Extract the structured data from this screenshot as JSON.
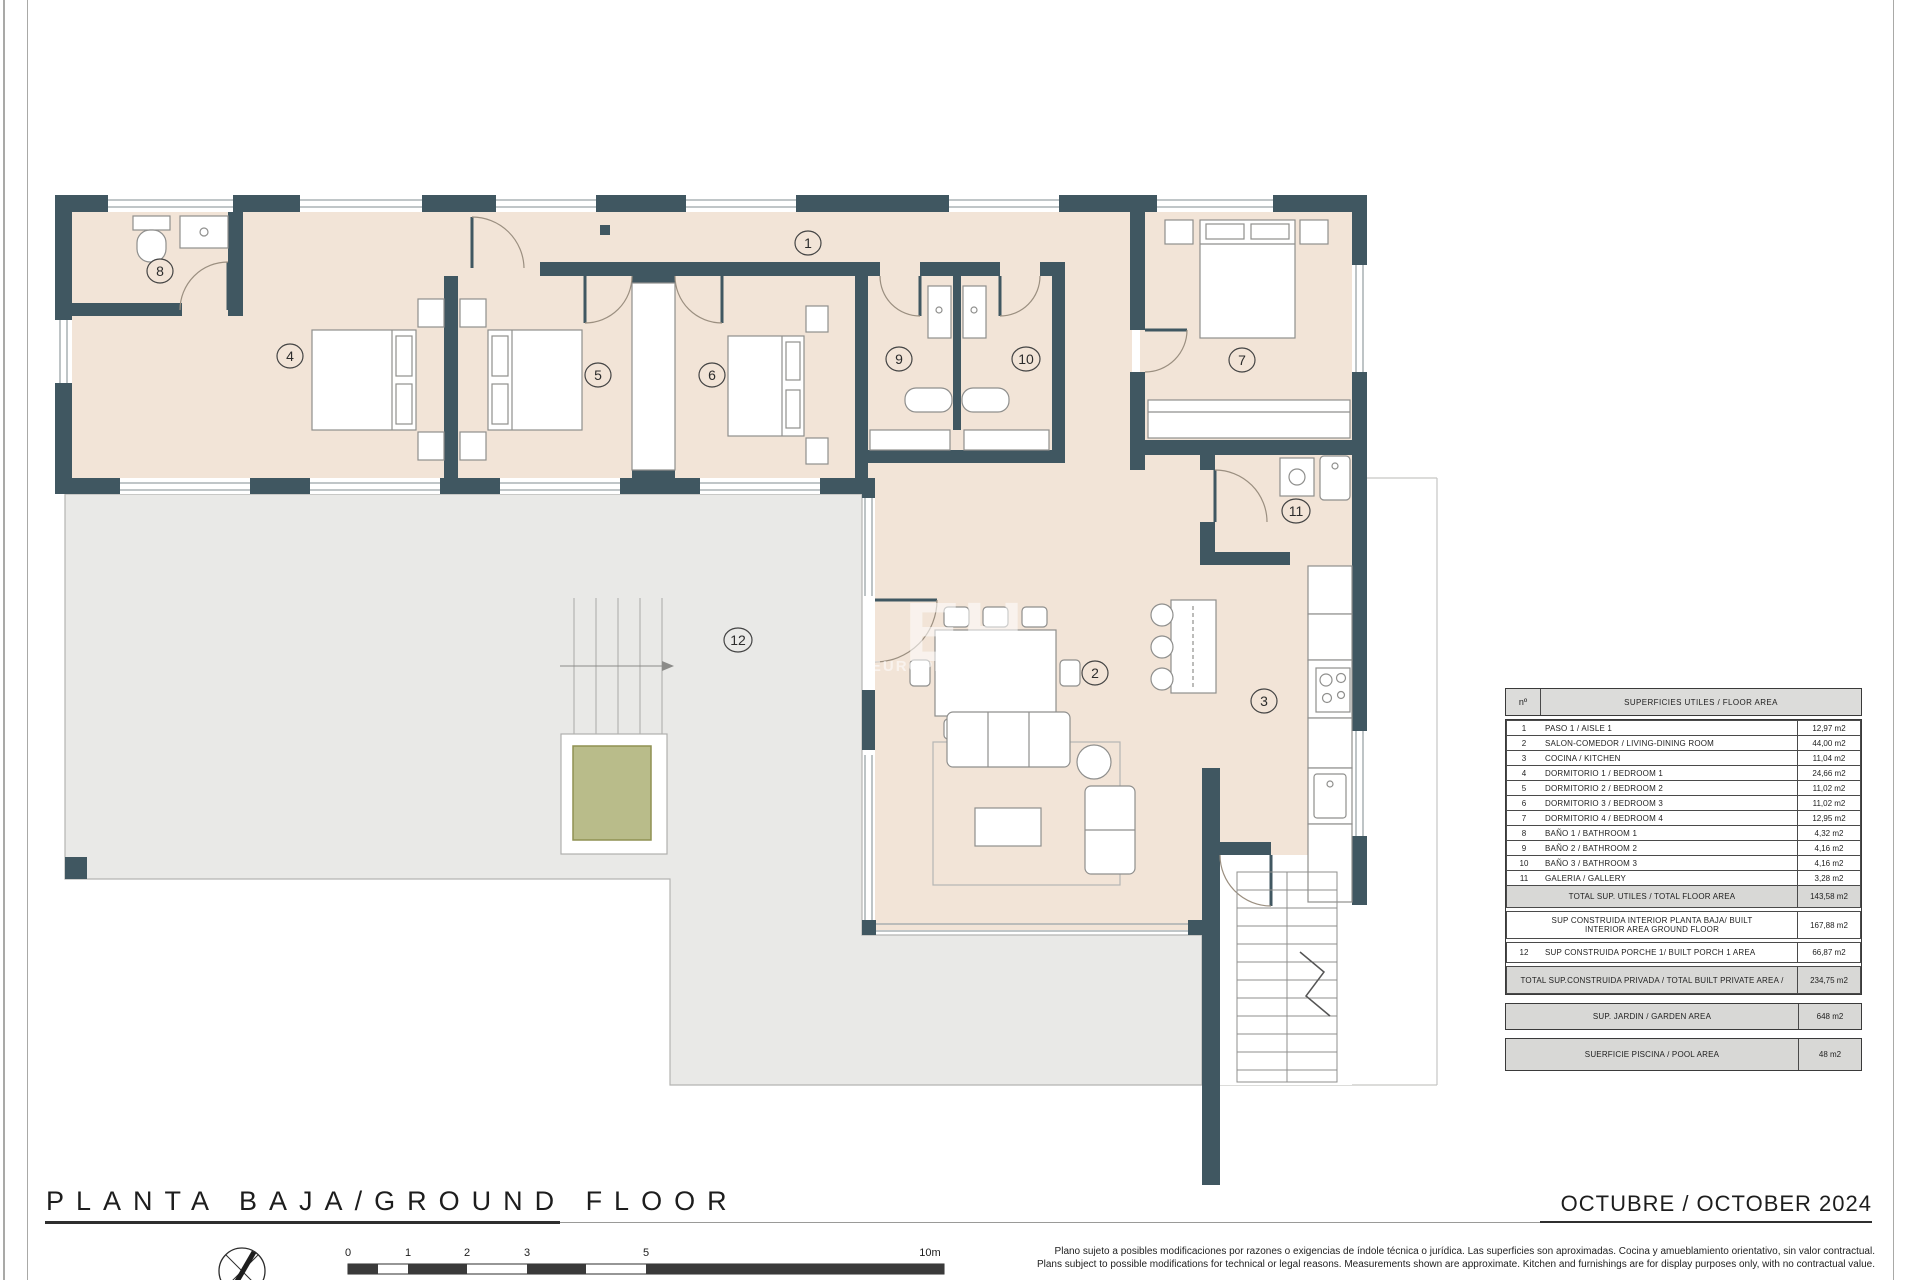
{
  "page": {
    "title": "PLANTA BAJA/GROUND FLOOR",
    "date": "OCTUBRE / OCTOBER 2024",
    "disclaimer_es": "Plano sujeto a posibles modificaciones por razones o exigencias de índole técnica o jurídica. Las superficies son aproximadas. Cocina y amueblamiento orientativo, sin valor contractual.",
    "disclaimer_en": "Plans subject to possible modifications for technical or legal reasons. Measurements shown are approximate. Kitchen and furnishings are for display purposes only, with no contractual value."
  },
  "watermark": {
    "initials": "EH",
    "name_primary": "EUROPE",
    "name_secondary": "h o m e s"
  },
  "colors": {
    "wall": "#405761",
    "floor": "#f2e4d7",
    "terrace": "#e9e9e7",
    "pool_green": "#b9bc8a",
    "table_gray": "#d8d8d6"
  },
  "scalebar": {
    "labels": [
      "0",
      "1",
      "2",
      "3",
      "5",
      "10m"
    ]
  },
  "plan": {
    "rooms": [
      {
        "num": "1",
        "label": "PASO 1 / AISLE 1"
      },
      {
        "num": "2",
        "label": "SALON-COMEDOR / LIVING-DINING ROOM"
      },
      {
        "num": "3",
        "label": "COCINA / KITCHEN"
      },
      {
        "num": "4",
        "label": "DORMITORIO 1 / BEDROOM 1"
      },
      {
        "num": "5",
        "label": "DORMITORIO 2 / BEDROOM 2"
      },
      {
        "num": "6",
        "label": "DORMITORIO 3 / BEDROOM 3"
      },
      {
        "num": "7",
        "label": "DORMITORIO 4 / BEDROOM 4"
      },
      {
        "num": "8",
        "label": "BAÑO 1 / BATHROOM 1"
      },
      {
        "num": "9",
        "label": "BAÑO 2 / BATHROOM 2"
      },
      {
        "num": "10",
        "label": "BAÑO 3 / BATHROOM 3"
      },
      {
        "num": "11",
        "label": "GALERIA / GALLERY"
      },
      {
        "num": "12",
        "label": "SUP CONSTRUIDA PORCHE 1/ BUILT PORCH 1 AREA"
      }
    ]
  },
  "legend": {
    "header": {
      "num": "nº",
      "label": "SUPERFICIES UTILES  / FLOOR AREA"
    },
    "rows": [
      {
        "num": "1",
        "label": "PASO 1 / AISLE 1",
        "area": "12,97 m2"
      },
      {
        "num": "2",
        "label": "SALON-COMEDOR /  LIVING-DINING ROOM",
        "area": "44,00 m2"
      },
      {
        "num": "3",
        "label": "COCINA / KITCHEN",
        "area": "11,04 m2"
      },
      {
        "num": "4",
        "label": "DORMITORIO 1 / BEDROOM 1",
        "area": "24,66 m2"
      },
      {
        "num": "5",
        "label": "DORMITORIO 2 / BEDROOM 2",
        "area": "11,02 m2"
      },
      {
        "num": "6",
        "label": "DORMITORIO 3 / BEDROOM 3",
        "area": "11,02 m2"
      },
      {
        "num": "7",
        "label": "DORMITORIO 4 / BEDROOM 4",
        "area": "12,95 m2"
      },
      {
        "num": "8",
        "label": "BAÑO 1 / BATHROOM 1",
        "area": "4,32 m2"
      },
      {
        "num": "9",
        "label": "BAÑO 2 / BATHROOM 2",
        "area": "4,16 m2"
      },
      {
        "num": "10",
        "label": "BAÑO 3 / BATHROOM 3",
        "area": "4,16 m2"
      },
      {
        "num": "11",
        "label": "GALERIA / GALLERY",
        "area": "3,28 m2"
      },
      {
        "num": "",
        "label": "TOTAL SUP. UTILES / TOTAL FLOOR AREA",
        "area": "143,58 m2"
      },
      {
        "num": "",
        "label": "SUP CONSTRUIDA INTERIOR PLANTA BAJA/ BUILT INTERIOR AREA GROUND FLOOR",
        "area": "167,88 m2"
      },
      {
        "num": "12",
        "label": "SUP CONSTRUIDA PORCHE 1/ BUILT PORCH 1 AREA",
        "area": "66,87 m2"
      },
      {
        "num": "",
        "label": "TOTAL SUP.CONSTRUIDA PRIVADA / TOTAL  BUILT PRIVATE AREA /",
        "area": "234,75 m2"
      },
      {
        "num": "",
        "label": "SUP. JARDIN / GARDEN AREA",
        "area": "648 m2"
      },
      {
        "num": "",
        "label": "SUERFICIE PISCINA / POOL AREA",
        "area": "48 m2"
      }
    ]
  }
}
